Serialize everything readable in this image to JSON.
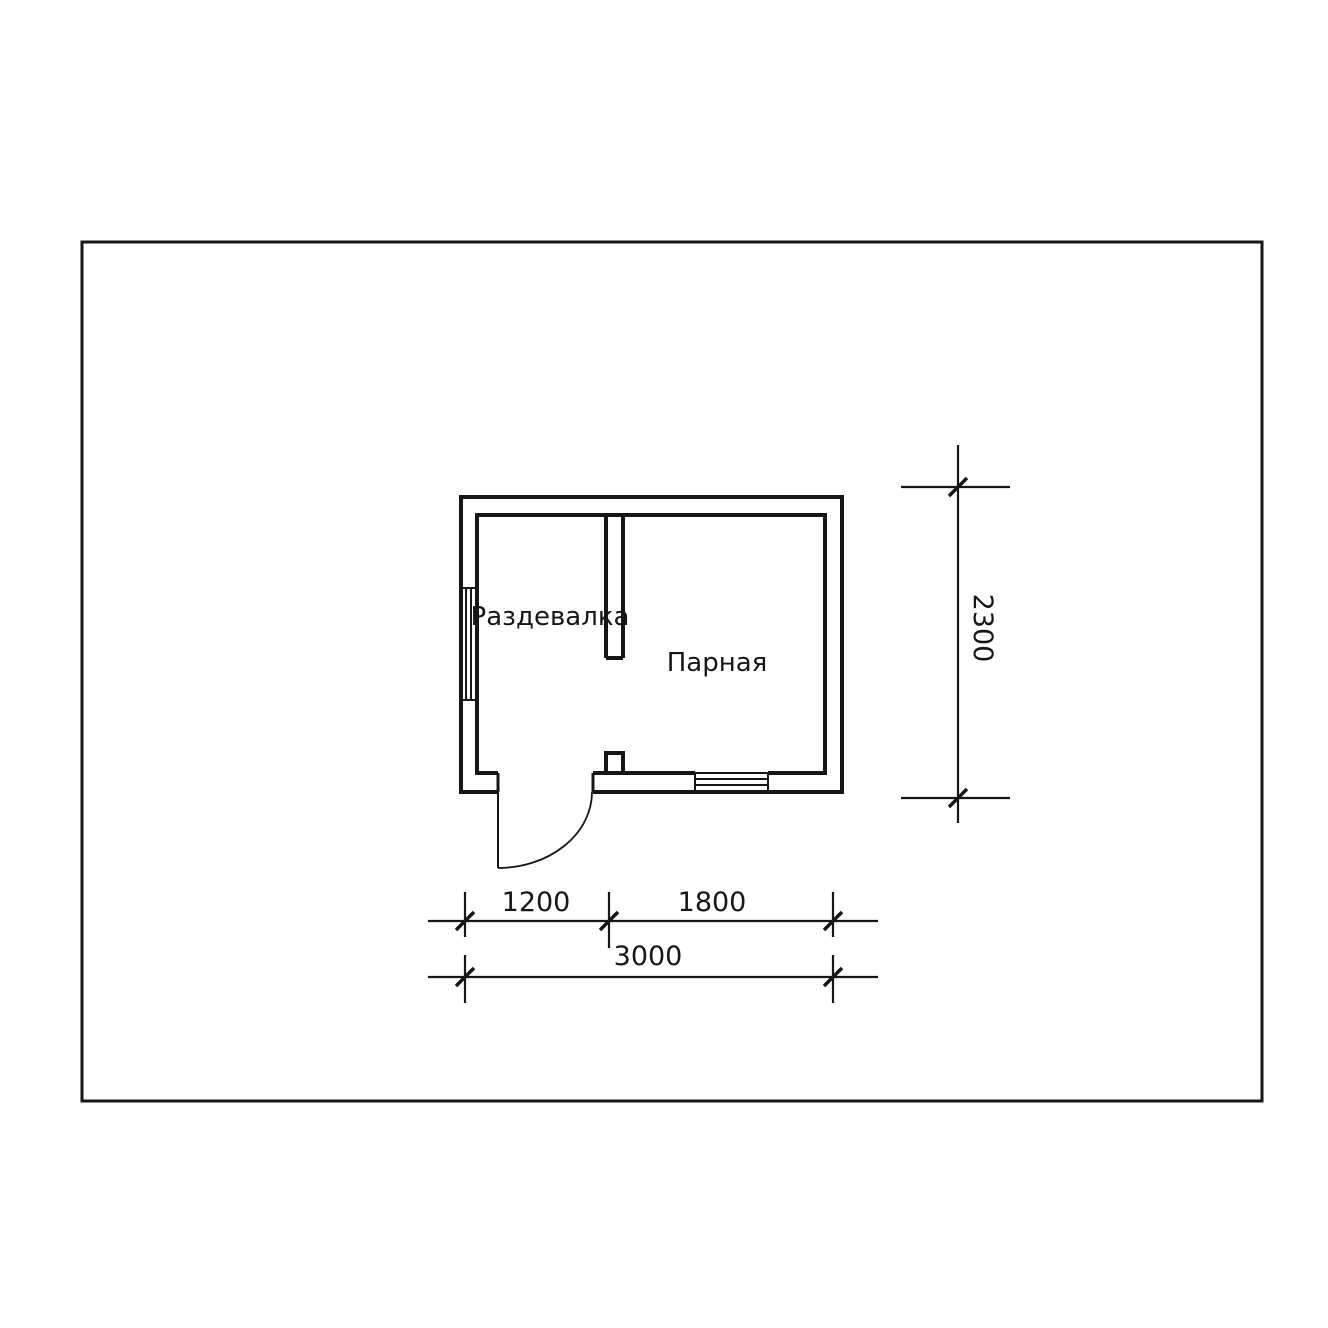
{
  "plan": {
    "rooms": [
      {
        "label": "Раздевалка"
      },
      {
        "label": "Парная"
      }
    ],
    "dimensions": {
      "horizontal_segments": [
        {
          "value": "1200"
        },
        {
          "value": "1800"
        }
      ],
      "horizontal_total": {
        "value": "3000"
      },
      "vertical_total": {
        "value": "2300"
      }
    },
    "colors": {
      "line": "#161616",
      "background": "#ffffff"
    }
  }
}
